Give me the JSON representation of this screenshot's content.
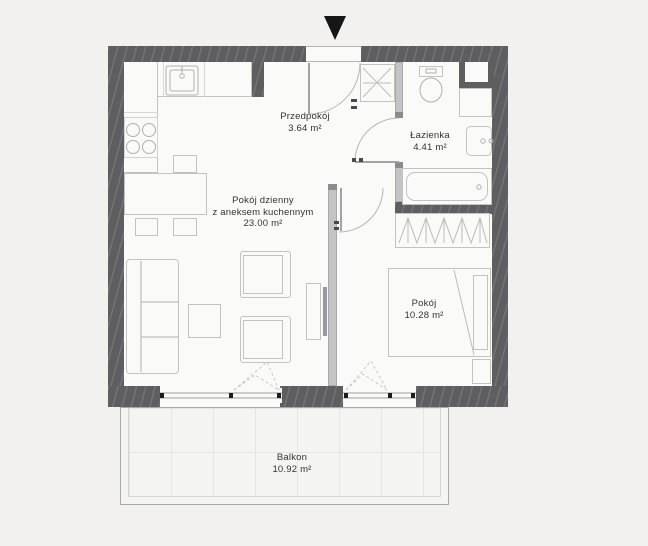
{
  "rooms": {
    "hallway": {
      "name": "Przedpokój",
      "area": "3.64 m²"
    },
    "bathroom": {
      "name": "Łazienka",
      "area": "4.41 m²"
    },
    "living": {
      "name": "Pokój dzienny",
      "subtitle": "z aneksem kuchennym",
      "area": "23.00 m²"
    },
    "bedroom": {
      "name": "Pokój",
      "area": "10.28 m²"
    },
    "balcony": {
      "name": "Balkon",
      "area": "10.92 m²"
    }
  },
  "icons": {
    "entrance_marker": "triangle-down"
  },
  "colors": {
    "background": "#f2f1ef",
    "floor": "#fafaf8",
    "wall": "#5e5e60",
    "partition": "#c4c4c6",
    "furniture_outline": "#c2c2c0",
    "symbol": "#b0b0ae",
    "text": "#333333",
    "accent_black": "#161616"
  }
}
